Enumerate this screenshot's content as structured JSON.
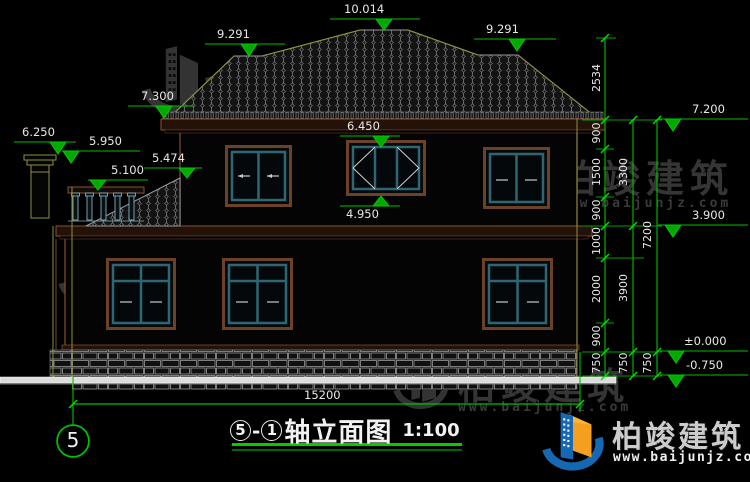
{
  "title": {
    "bubble1": "5",
    "dash": "-",
    "bubble2": "1",
    "text": "轴立面图",
    "scale": "1:100"
  },
  "axis": {
    "bubble": "5"
  },
  "elev": {
    "ridge": "10.014",
    "sub_left": "9.291",
    "sub_right": "9.291",
    "eave_left": "7.300",
    "chimney_top": "6.250",
    "chimney_cap": "5.950",
    "shed_top": "5.474",
    "railing_top": "5.100",
    "window_head": "6.450",
    "window_sill": "4.950",
    "eave_right": "7.200",
    "second_floor": "3.900",
    "zero_level": "±0.000",
    "ground": "-0.750"
  },
  "dims": {
    "total_width": "15200",
    "chainA": [
      "2534",
      "900",
      "1500",
      "900",
      "1000",
      "2000",
      "900",
      "750"
    ],
    "chainB": [
      "3300",
      "3900",
      "750"
    ],
    "chainC": [
      "7200",
      "750"
    ]
  },
  "watermark": {
    "name": "柏竣建筑",
    "url": "www.baijunjz.com"
  },
  "brand": {
    "name": "柏竣建筑",
    "url": "www.baijunjz.com"
  },
  "colors": {
    "dim_green": "#00bf00",
    "axis_yellow": "#8f8f3a",
    "frame_brown": "#6b4226",
    "sash_teal": "#2e6673"
  }
}
